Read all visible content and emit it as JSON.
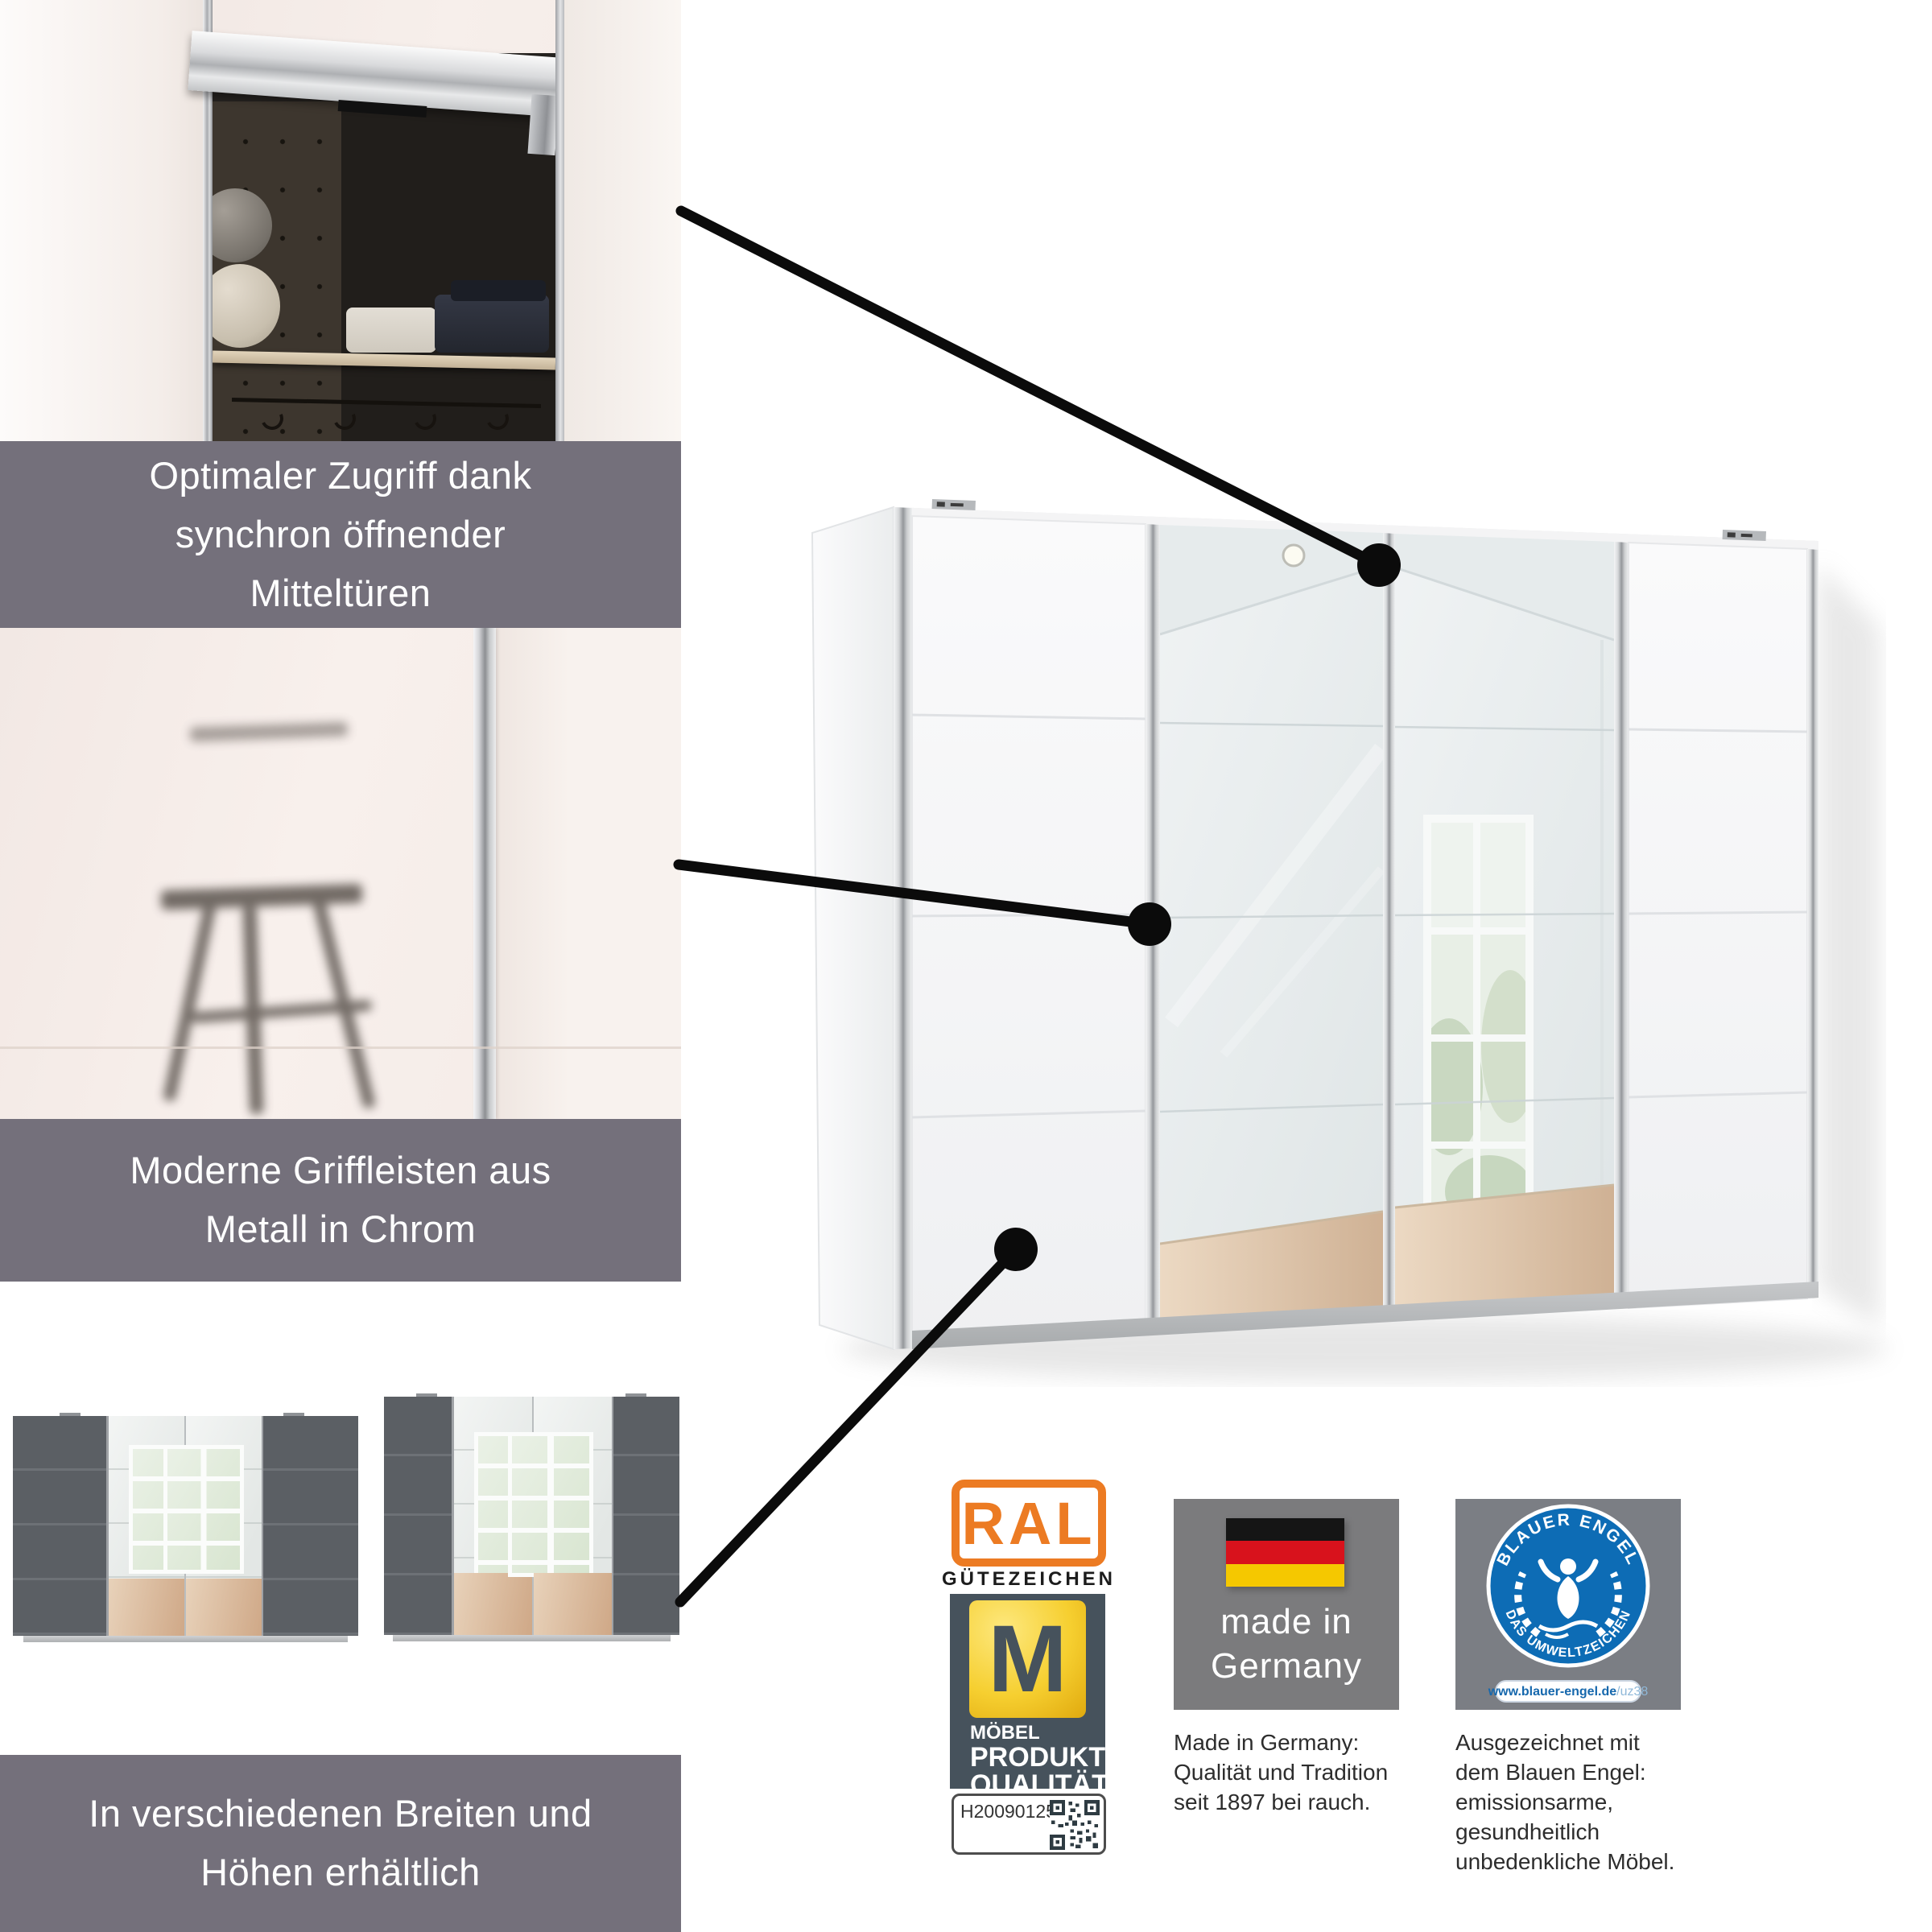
{
  "banners": {
    "feature1": {
      "lines": [
        "Optimaler Zugriff dank",
        "synchron öffnender",
        "Mitteltüren"
      ]
    },
    "feature2": {
      "lines": [
        "Moderne Griffleisten aus",
        "Metall in Chrom"
      ]
    },
    "feature3": {
      "lines": [
        "In verschiedenen Breiten und",
        "Höhen erhältlich"
      ]
    }
  },
  "badges": {
    "ral": {
      "logo_text": "RAL",
      "subtitle": "GÜTEZEICHEN",
      "m_letter": "M",
      "label_small": "MÖBEL",
      "label_line1": "PRODUKT",
      "label_line2": "QUALITÄT",
      "serial_number": "H20090125"
    },
    "made_in_germany": {
      "badge_line1": "made in",
      "badge_line2": "Germany",
      "caption_lines": [
        "Made in Germany:",
        "Qualität und Tradition",
        "seit 1897 bei rauch."
      ]
    },
    "blauer_engel": {
      "arc_top": "BLAUER ENGEL",
      "arc_bottom": "DAS UMWELTZEICHEN",
      "url_main": "www.blauer-engel.de",
      "url_suffix": "/uz38",
      "caption_lines": [
        "Ausgezeichnet mit",
        "dem Blauen Engel:",
        "emissionsarme,",
        "gesundheitlich",
        "unbedenkliche Möbel."
      ]
    }
  },
  "colors": {
    "banner_gray": "#74707B",
    "ral_orange": "#EC7B23",
    "m_card_slate": "#46525C",
    "m_gold": "#F2C21E",
    "engel_blue": "#0D6CB5",
    "flag_black": "#151515",
    "flag_red": "#D8121C",
    "flag_gold": "#F5C800",
    "callout_black": "#0B0B0B",
    "wardrobe_white": "#F5F5F7",
    "variant_dark_gray": "#5B5F64"
  }
}
